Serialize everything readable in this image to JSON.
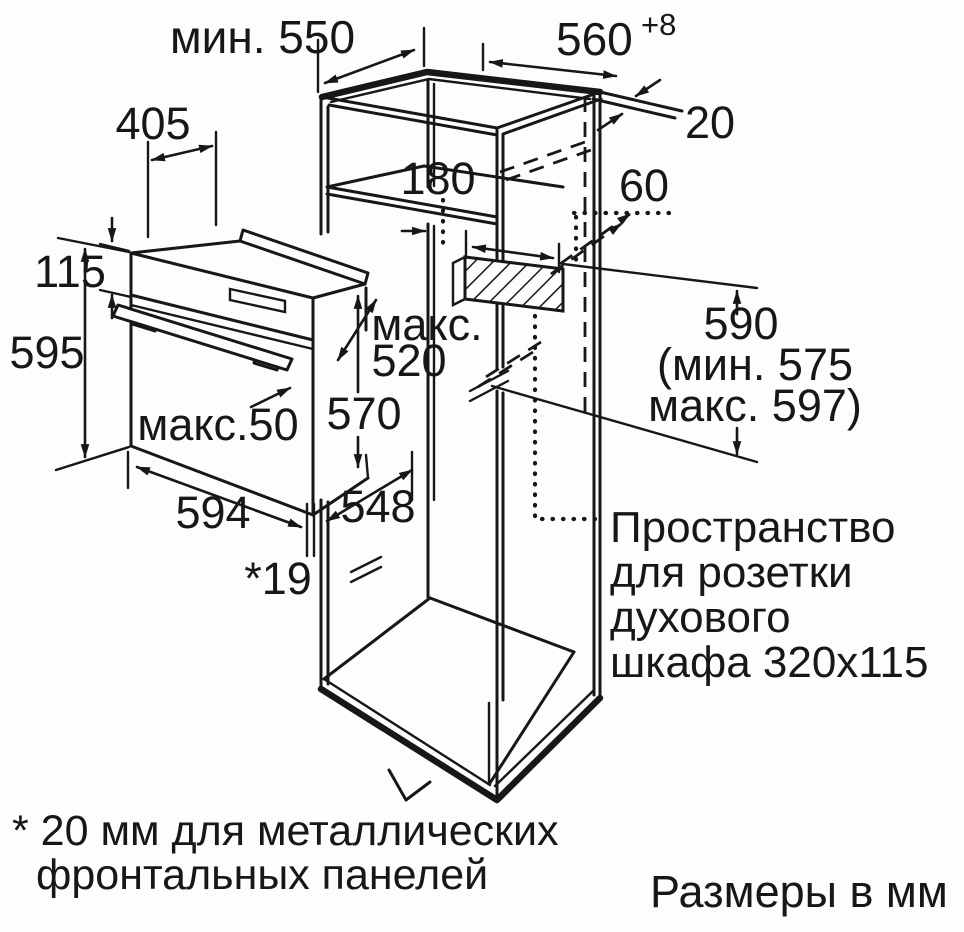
{
  "diagram": {
    "title_hint": "Oven installation dimensions drawing",
    "colors": {
      "line": "#171717",
      "background": "#fdfdfd"
    },
    "labels": {
      "min_depth": "мин. 550",
      "niche_width": "560",
      "niche_width_sup": "+8",
      "top_depth": "405",
      "wall_thickness": "20",
      "upper_niche": "180",
      "socket_offset": "60",
      "front_strip": "115",
      "front_height": "595",
      "max_word": "макс.",
      "max_depth": "520",
      "body_height": "570",
      "handle_max": "макс.50",
      "oven_width": "594",
      "body_depth": "548",
      "front_gap": "*19",
      "niche_height": "590",
      "niche_height_min": "(мин. 575",
      "niche_height_max": "макс. 597)",
      "socket_note_1": "Пространство",
      "socket_note_2": "для розетки",
      "socket_note_3": "духового",
      "socket_note_4": "шкафа 320x115",
      "footnote_1": "* 20 мм для металлических",
      "footnote_2": "фронтальных панелей",
      "units_note": "Размеры в мм"
    }
  }
}
